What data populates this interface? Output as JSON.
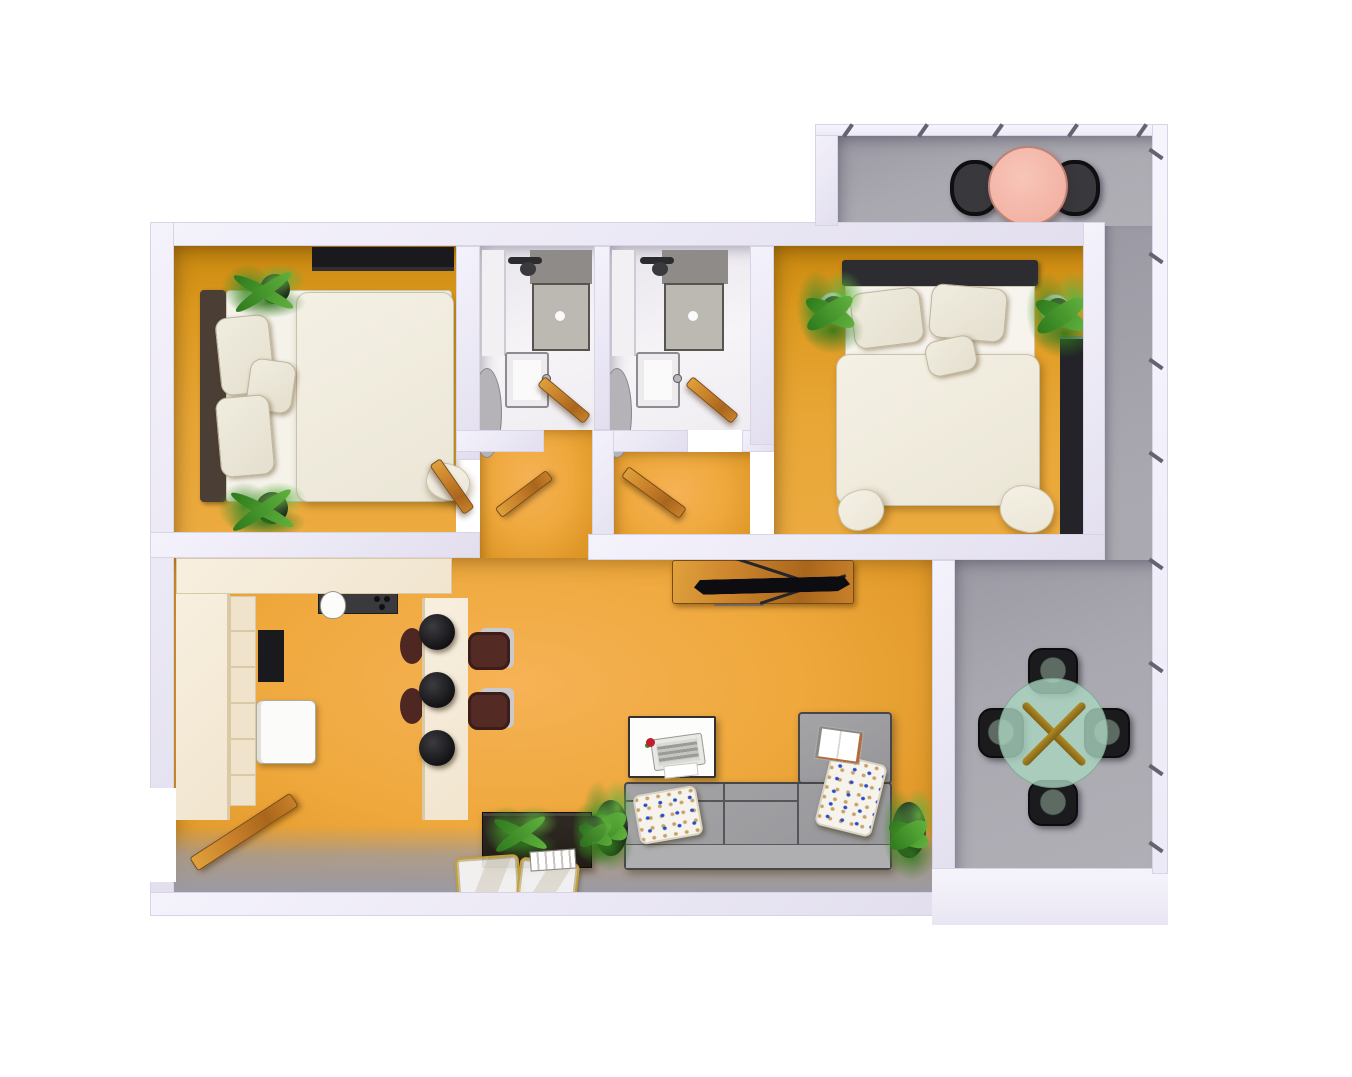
{
  "scene": {
    "kind": "3d-apartment-floor-plan-render",
    "view": "top-down axonometric",
    "background_color": "#FFFFFF",
    "no_visible_text": true
  },
  "palette": {
    "wall": "#ECEAF5",
    "floor_living_orange": "#EEA83C",
    "floor_bedroom_orange": "#DD9A1F",
    "floor_balcony_gray": "#A9A8B0",
    "floor_bathroom_white": "#F4F2F4",
    "door_wood": "#C8802A",
    "tv_console_wood": "#B06B2B",
    "sofa_gray": "#9C9C9F",
    "bedding_cream": "#EFEBDD",
    "headboard_brown": "#4A3E35",
    "headboard_dark": "#2C2C31",
    "kitchen_cream": "#F3E9D8",
    "stool_black": "#1B1B1E",
    "chair_maroon": "#542A25",
    "balcony_table_pink": "#F5BBAD",
    "terrace_table_teal": "#AAD4BF",
    "basket_gold": "#C5A033",
    "plant_green": "#4E9A33",
    "pillow_dot_blue": "#2A4CC4",
    "pillow_dot_tan": "#C5A266"
  },
  "rooms": [
    {
      "id": "bedroom-1",
      "label": "bedroom left",
      "furniture": [
        "wardrobe",
        "double-bed",
        "headboard",
        "pillows x3",
        "duvet",
        "plant x2",
        "wood-door"
      ]
    },
    {
      "id": "bathroom-1",
      "label": "bathroom left",
      "furniture": [
        "shower-tray",
        "shower-fixture",
        "tall-cabinet",
        "sink",
        "laundry-basket",
        "wood-door"
      ]
    },
    {
      "id": "bathroom-2",
      "label": "bathroom right",
      "furniture": [
        "shower-tray",
        "shower-fixture",
        "tall-cabinet",
        "sink",
        "laundry-basket",
        "wood-door"
      ]
    },
    {
      "id": "bedroom-2",
      "label": "bedroom right",
      "furniture": [
        "double-bed",
        "headboard",
        "pillows x3",
        "duvet",
        "nightstand x2",
        "plant x2",
        "bookshelf"
      ]
    },
    {
      "id": "vestibule",
      "label": "inner hallway left",
      "furniture": [
        "wood-door"
      ]
    },
    {
      "id": "hall",
      "label": "inner hallway right",
      "furniture": [
        "wood-door"
      ]
    },
    {
      "id": "kitchen",
      "label": "open kitchen",
      "furniture": [
        "upper-cabinets",
        "appliance-niche",
        "cooktop",
        "sink",
        "tall-cabinet-column",
        "shelf-column",
        "built-in-oven",
        "fridge",
        "bar-counter",
        "bar-stool x3",
        "maroon-chair x4"
      ]
    },
    {
      "id": "living-room",
      "label": "living room",
      "furniture": [
        "tv-console",
        "tv",
        "gray-mat",
        "coffee-table",
        "laptop",
        "flower",
        "paper-sheet",
        "l-shaped-sofa",
        "patterned-pillow x2",
        "open-magazine",
        "plant x2",
        "wood-crate",
        "crate-plant",
        "bottle",
        "book-stack",
        "gold-basket x2",
        "entry-door"
      ]
    },
    {
      "id": "balcony-top",
      "label": "upper balcony",
      "furniture": [
        "round-pink-table",
        "black-wire-chair x2",
        "railing"
      ]
    },
    {
      "id": "balcony-strip",
      "label": "side balcony strip",
      "furniture": [
        "railing"
      ]
    },
    {
      "id": "terrace",
      "label": "lower terrace",
      "furniture": [
        "round-glass-table-teal",
        "crossed-gold-legs",
        "black-chair x4",
        "railing"
      ]
    }
  ]
}
